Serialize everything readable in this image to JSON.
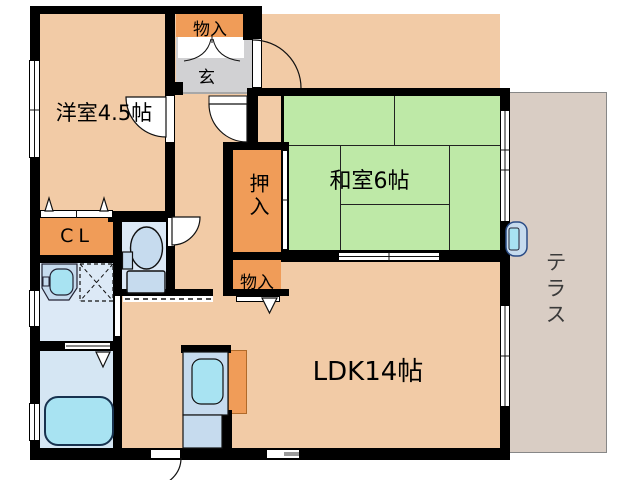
{
  "title": "apartment-floor-plan",
  "rooms": {
    "youshitsu": {
      "label": "洋室4.5帖"
    },
    "washitsu": {
      "label": "和室6帖"
    },
    "ldk": {
      "label": "LDK14帖"
    },
    "terrace": {
      "label": "テラス"
    },
    "genkan": {
      "label": "玄"
    },
    "storage_top": {
      "label": "物入"
    },
    "storage_mid": {
      "label": "物入"
    },
    "oshiire": {
      "label": "押入"
    },
    "closet": {
      "label": "CL"
    }
  },
  "colors": {
    "wall": "#000000",
    "room_peach": "#F2CBA6",
    "storage_orange": "#F09C58",
    "tatami_green": "#BEE9A7",
    "genkan_gray": "#D1D1D3",
    "terrace_gray": "#D9CDC4",
    "wet_room_blue": "#DCE9F6",
    "bath_blue": "#D5E6F3",
    "fixture_blue": "#C6DBEE",
    "water_cyan": "#A8E3F2"
  }
}
